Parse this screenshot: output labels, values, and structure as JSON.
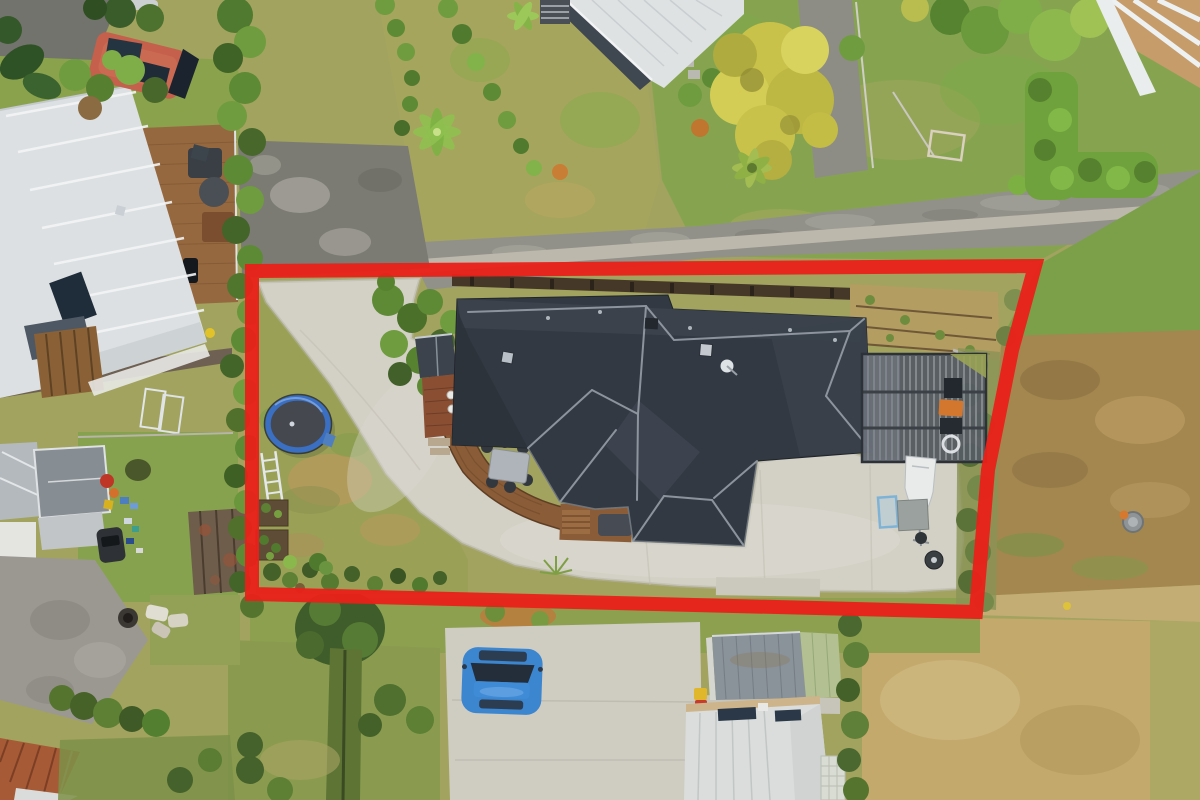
{
  "scene": {
    "kind": "aerial-drone-photo",
    "subject": "residential property with red boundary outline annotation"
  },
  "boundary": {
    "color": "#e8211a",
    "stroke_width": 14,
    "points": "252,271 1035,266 1012,350 988,470 976,612 252,594"
  },
  "palette": {
    "base_grass": "#a1a35e",
    "lawn_green": "#86a450",
    "subject_lawn": "#9aa156",
    "road_asphalt": "#91918a",
    "dark_asphalt": "#7b7b74",
    "footpath": "#bcb8ac",
    "concrete_driveway": "#d3d0c6",
    "house_roof": "#333942",
    "roof_ridge": "#9ca3ac",
    "deck_wood": "#8a5c38",
    "nw_neighbour_roof": "#dde0e2",
    "sw_neighbour_roof": "#878e93",
    "shed_roof": "#8a929a",
    "white_outbuilding": "#dadddc",
    "trampoline_ring": "#3a6fc2",
    "trampoline_mat": "#45484e",
    "blue_car": "#3c86d0",
    "camper_van": "#c4604b",
    "hedge_dark": "#44612a",
    "hedge_bright": "#6f9c3f",
    "yellow_tree": "#c9c24a",
    "dry_field": "#c3a96c",
    "dirt_bank": "#a3874f",
    "timber_wall": "#463829"
  },
  "objects": [
    {
      "id": "property-boundary",
      "label": "red outlined lot"
    },
    {
      "id": "subject-house",
      "label": "dark charcoal hip roof house"
    },
    {
      "id": "carport-pergola",
      "label": "slatted carport"
    },
    {
      "id": "boat",
      "label": "white boat on trailer"
    },
    {
      "id": "trampoline",
      "label": "blue ring trampoline"
    },
    {
      "id": "curved-driveway",
      "label": "concrete driveway"
    },
    {
      "id": "timber-deck",
      "label": "curved wooden deck with outdoor dining set"
    },
    {
      "id": "nw-neighbour-house",
      "label": "silver roof house with deck and red camper van"
    },
    {
      "id": "sw-neighbour-house",
      "label": "grey roof house with gravel drive"
    },
    {
      "id": "south-garage",
      "label": "grey corrugated garage"
    },
    {
      "id": "south-white-building",
      "label": "white roof outbuilding with solar panels"
    },
    {
      "id": "blue-hatchback",
      "label": "blue car on concrete pad"
    },
    {
      "id": "yellow-tree",
      "label": "large yellow-green tree"
    },
    {
      "id": "road",
      "label": "street with footpath"
    },
    {
      "id": "dry-paddock",
      "label": "brown dry grass field"
    }
  ]
}
